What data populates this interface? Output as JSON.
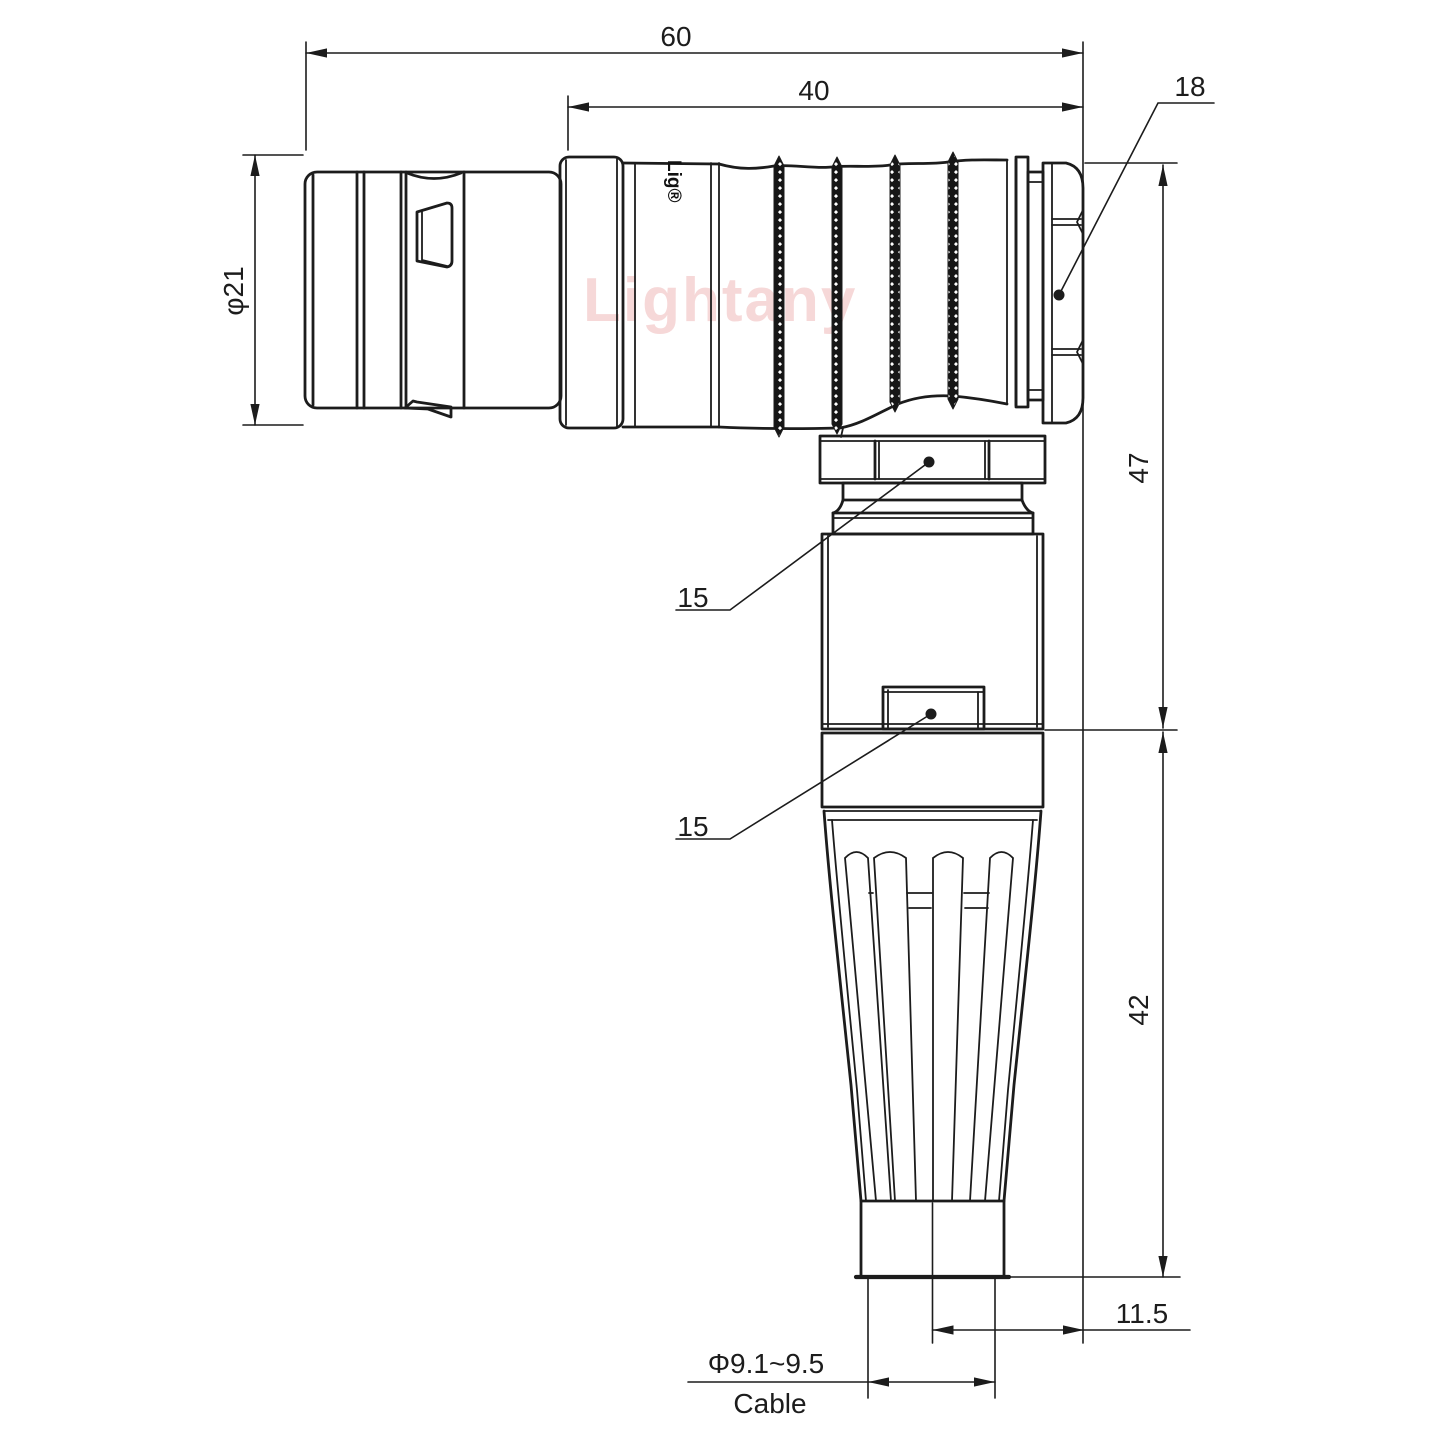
{
  "meta": {
    "kind": "technical-dimension-drawing",
    "subject": "right-angle circular push-pull connector with cable strain relief"
  },
  "colors": {
    "line": "#1c1c1c",
    "watermark_pink": "#eeb2b2",
    "background": "#ffffff"
  },
  "labels": {
    "dim_overall_length": "60",
    "dim_upper_body_length": "40",
    "dim_nut_across_flats": "18",
    "dim_plug_diameter": "φ21",
    "dim_height_upper": "47",
    "dim_nut_width_upper": "15",
    "dim_nut_width_lower": "15",
    "dim_height_lower": "42",
    "dim_cable_offset": "11.5",
    "dim_cable_diameter": "Φ9.1~9.5",
    "cable_caption": "Cable",
    "watermark": "Lightany",
    "brand_vertical": "Lig®"
  }
}
